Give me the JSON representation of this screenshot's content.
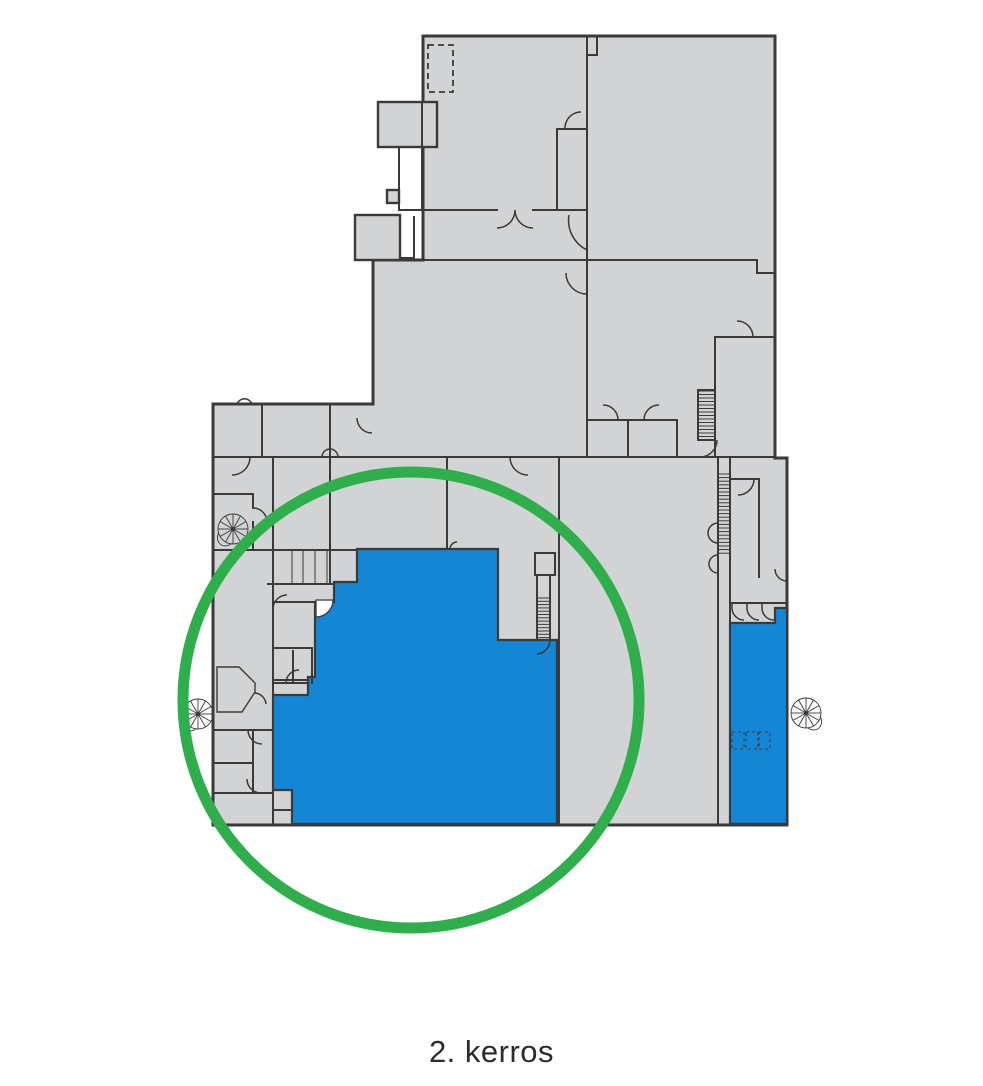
{
  "caption": {
    "text": "2. kerros"
  },
  "colors": {
    "background": "#ffffff",
    "floor_fill": "#d2d3d4",
    "wall_stroke": "#3a3a3a",
    "highlight_blue": "#1486d6",
    "annotation_green": "#2fae4c",
    "caption_color": "#2b2b2b"
  },
  "floorplan": {
    "type": "building-floor-plan",
    "floor_label": "2. kerros",
    "highlighted_zones": [
      {
        "name": "main-hall-highlight",
        "color_key": "highlight_blue"
      },
      {
        "name": "right-wing-strip-highlight",
        "color_key": "highlight_blue"
      }
    ],
    "annotations": [
      {
        "name": "green-circle-annotation",
        "shape": "circle",
        "color_key": "annotation_green"
      }
    ],
    "icons": [
      {
        "name": "spiral-staircase-icon",
        "location": "mid-left"
      },
      {
        "name": "spiral-staircase-icon",
        "location": "lower-left-exterior"
      },
      {
        "name": "spiral-staircase-icon",
        "location": "lower-right-exterior"
      }
    ],
    "features": [
      "stairwells-hatched",
      "door-swing-arcs",
      "dashed-room-outline"
    ]
  }
}
